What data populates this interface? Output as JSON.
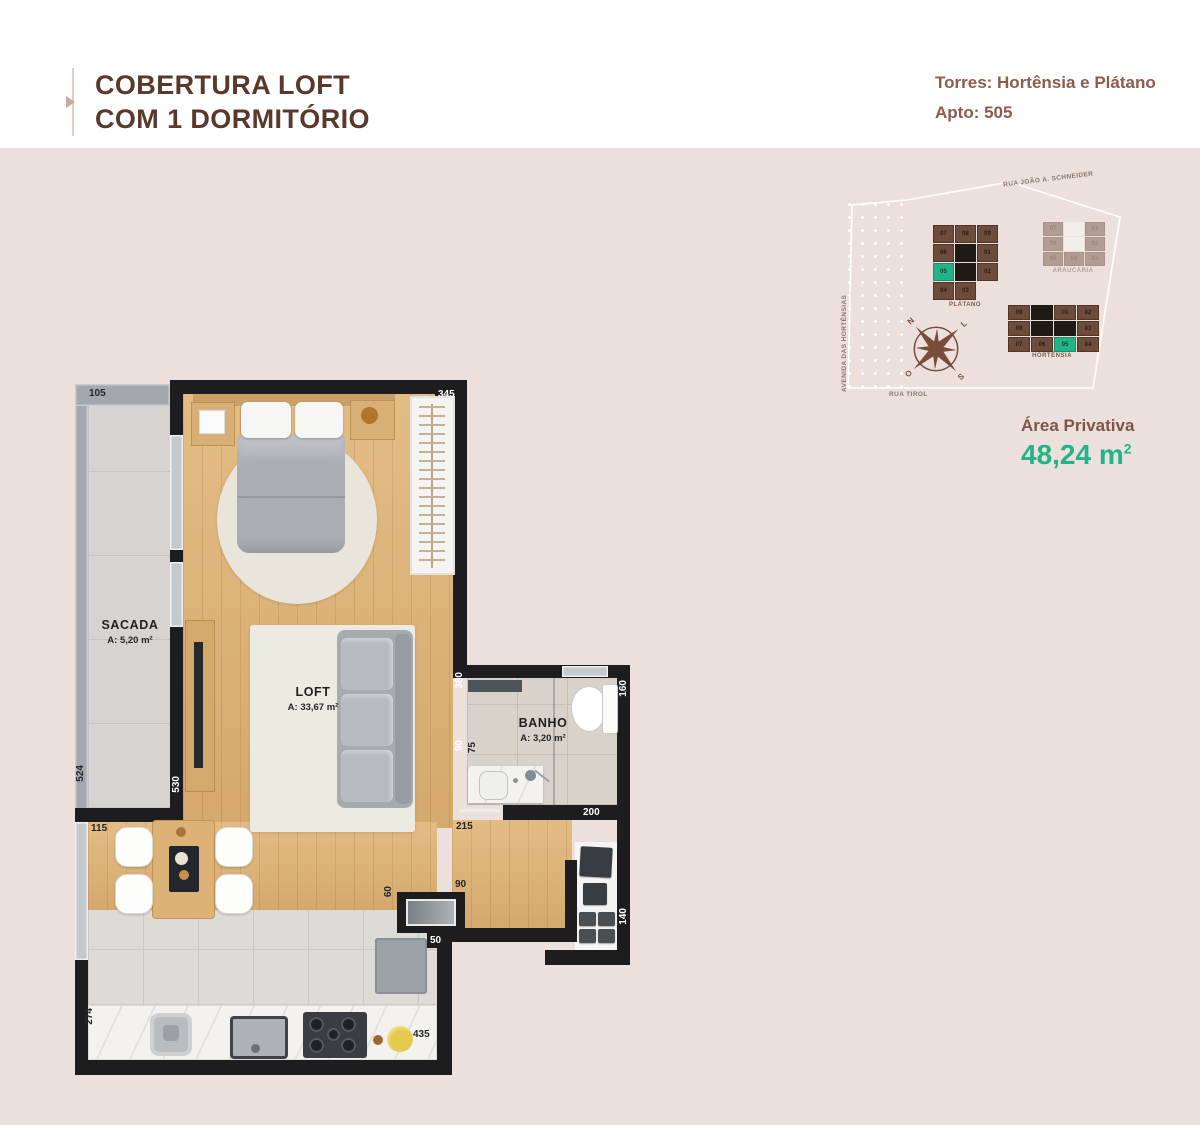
{
  "header": {
    "title_line1": "COBERTURA LOFT",
    "title_line2": "COM 1 DORMITÓRIO",
    "towers_label": "Torres: Hortênsia e Plátano",
    "apto_label": "Apto: 505"
  },
  "site_plan": {
    "streets": {
      "top": "RUA JOÃO A. SCHNEIDER",
      "left": "AVENIDA DAS HORTÊNSIAS",
      "bottom": "RUA TIROL"
    },
    "compass": {
      "n": "N",
      "l": "L",
      "o": "O",
      "s": "S"
    },
    "highlight_color": "#24b389",
    "buildings": [
      {
        "name": "PLÁTANO",
        "faded": false,
        "cells": [
          {
            "t": "07"
          },
          {
            "t": "08"
          },
          {
            "t": "09"
          },
          {
            "t": "06"
          },
          {
            "core": true
          },
          {
            "t": "01"
          },
          {
            "t": "05",
            "hl": true
          },
          {
            "core": true
          },
          {
            "t": "02"
          },
          {
            "t": "04"
          },
          {
            "t": "03"
          },
          {
            "t": ""
          }
        ]
      },
      {
        "name": "ARAUCÁRIA",
        "faded": true,
        "cells": [
          {
            "t": "07"
          },
          {
            "core": true
          },
          {
            "t": "01"
          },
          {
            "t": "06"
          },
          {
            "core": true
          },
          {
            "t": "02"
          },
          {
            "t": "05"
          },
          {
            "t": "04"
          },
          {
            "t": "03"
          }
        ]
      },
      {
        "name": "HORTÊNSIA",
        "faded": false,
        "cells": [
          {
            "t": "09"
          },
          {
            "core": true
          },
          {
            "t": "01"
          },
          {
            "t": "02"
          },
          {
            "t": "08"
          },
          {
            "core": true
          },
          {
            "core": true
          },
          {
            "t": "03"
          },
          {
            "t": "07"
          },
          {
            "t": "06"
          },
          {
            "t": "05",
            "hl": true
          },
          {
            "t": "04"
          }
        ]
      }
    ]
  },
  "area": {
    "label": "Área Privativa",
    "value": "48,24 m",
    "sup": "2"
  },
  "floor_plan": {
    "rooms": [
      {
        "name": "SACADA",
        "area": "A: 5,20 m²"
      },
      {
        "name": "LOFT",
        "area": "A: 33,67 m²"
      },
      {
        "name": "BANHO",
        "area": "A: 3,20 m²"
      }
    ],
    "dims": {
      "d105": "105",
      "d345": "345",
      "d524": "524",
      "d115": "115",
      "d530": "530",
      "d380": "380",
      "d90a": "90",
      "d75": "75",
      "d160": "160",
      "d200": "200",
      "d215": "215",
      "d140": "140",
      "d90b": "90",
      "d60": "60",
      "d50": "50",
      "d435": "435",
      "d274": "274"
    }
  }
}
